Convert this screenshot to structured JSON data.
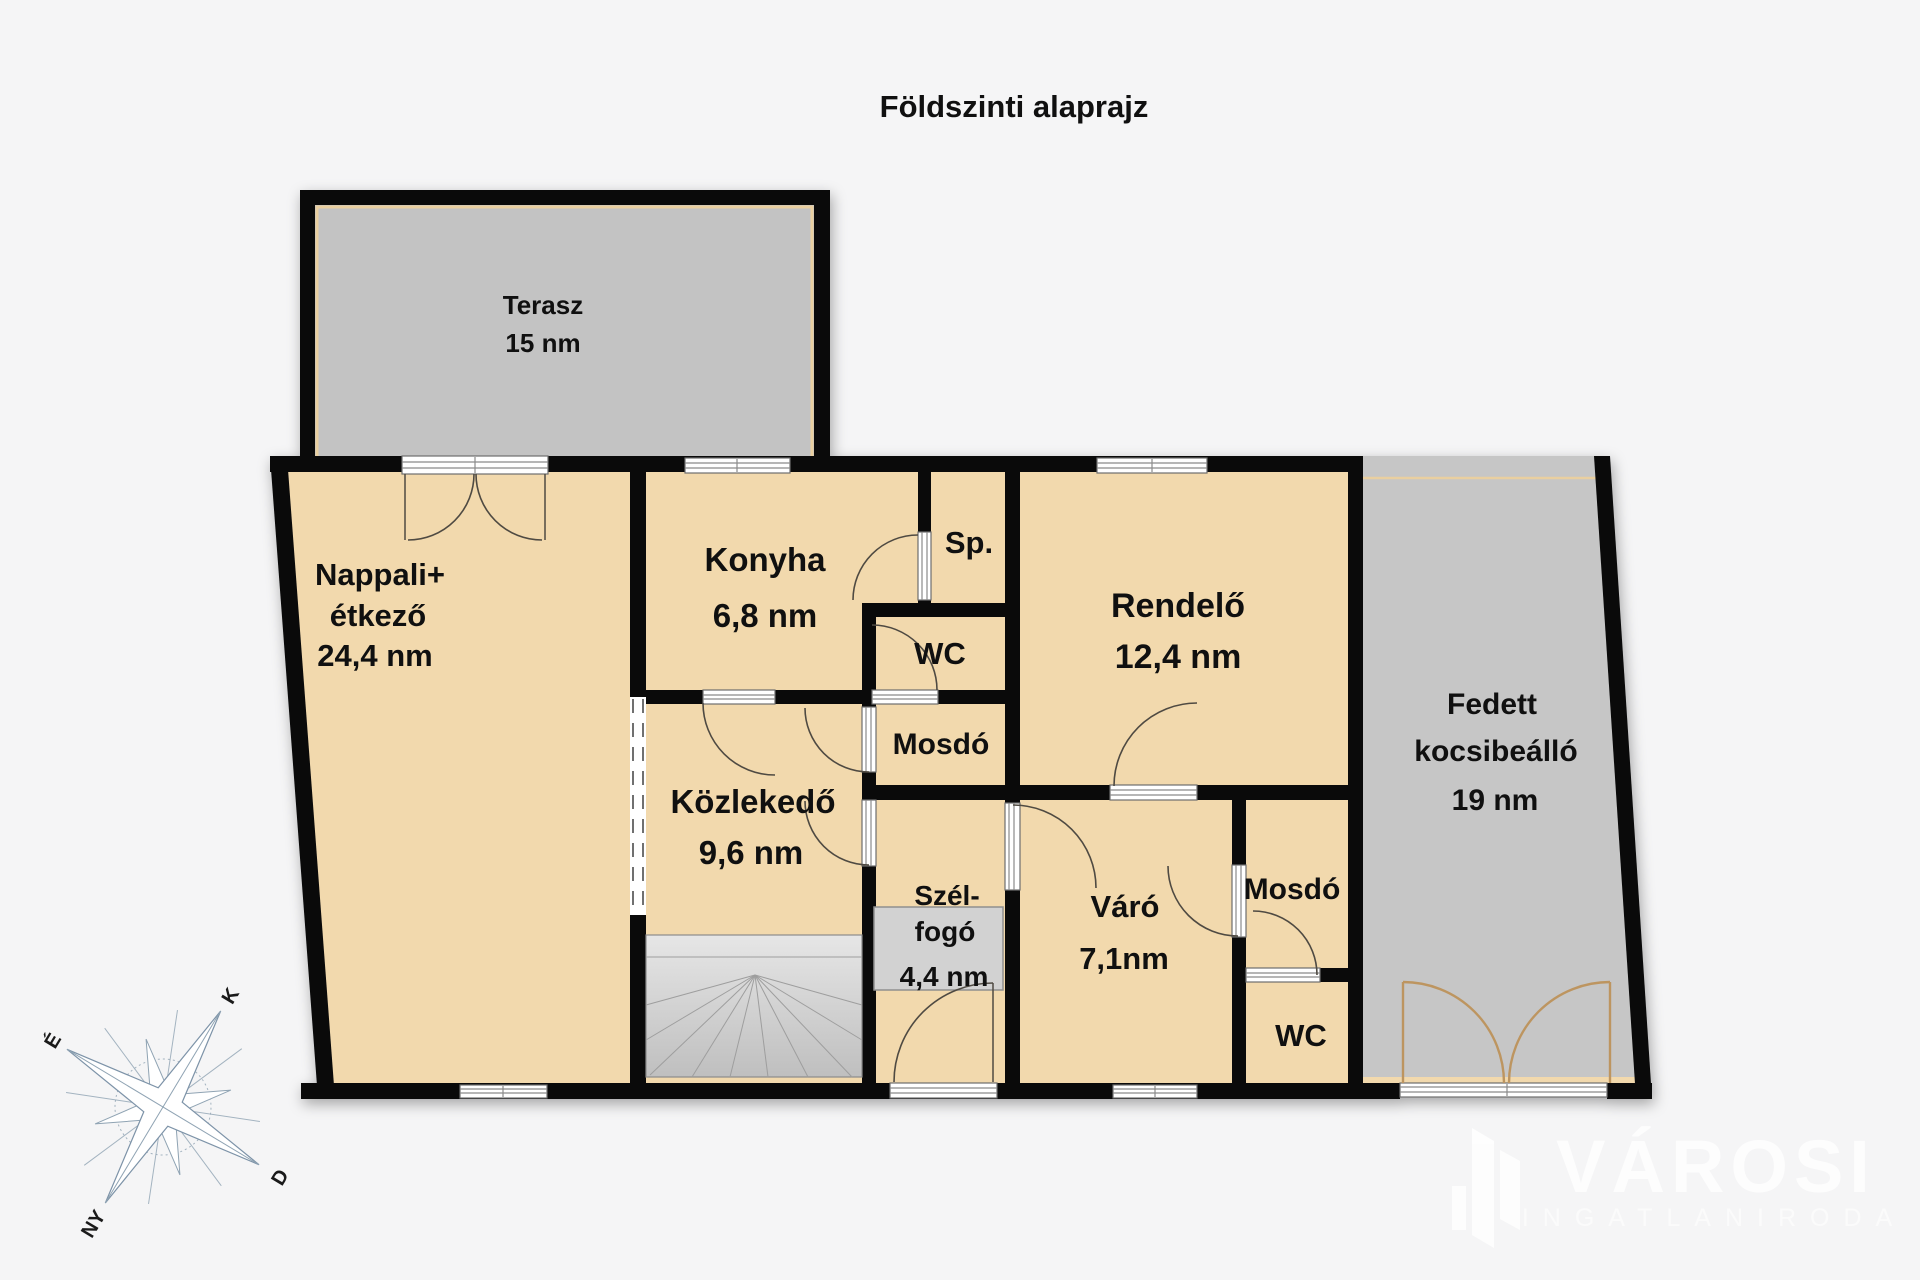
{
  "title": "Földszinti alaprajz",
  "colors": {
    "background": "#f5f5f6",
    "room_fill": "#f2d9ad",
    "wall": "#0a0a0a",
    "terrace_fill": "#c3c3c3",
    "carport_fill": "#c6c6c6",
    "trim": "#e9cfa0",
    "stairs_fill": "#d9d9d9",
    "doormat_fill": "#d2d2d2"
  },
  "rooms": {
    "terasz": {
      "name": "Terasz",
      "area": "15 nm"
    },
    "nappali": {
      "name_line1": "Nappali+",
      "name_line2": "étkező",
      "area": "24,4 nm"
    },
    "konyha": {
      "name": "Konyha",
      "area": "6,8 nm"
    },
    "spajz": {
      "name": "Sp."
    },
    "wc_central": {
      "name": "WC"
    },
    "mosdo_central": {
      "name": "Mosdó"
    },
    "rendelo": {
      "name": "Rendelő",
      "area": "12,4 nm"
    },
    "kozlekedo": {
      "name": "Közlekedő",
      "area": "9,6 nm"
    },
    "szelfogo": {
      "name_line1": "Szél-",
      "name_line2": "fogó",
      "area": "4,4 nm"
    },
    "varo": {
      "name": "Váró",
      "area": "7,1nm"
    },
    "mosdo_right": {
      "name": "Mosdó"
    },
    "wc_right": {
      "name": "WC"
    },
    "kocsibeallo": {
      "name_line1": "Fedett",
      "name_line2": "kocsibeálló",
      "area": "19 nm"
    }
  },
  "compass": {
    "north": "É",
    "east": "K",
    "south": "D",
    "west": "NY"
  },
  "watermark": {
    "brand": "VÁROSI",
    "subtitle": "INGATLANIRODA"
  }
}
